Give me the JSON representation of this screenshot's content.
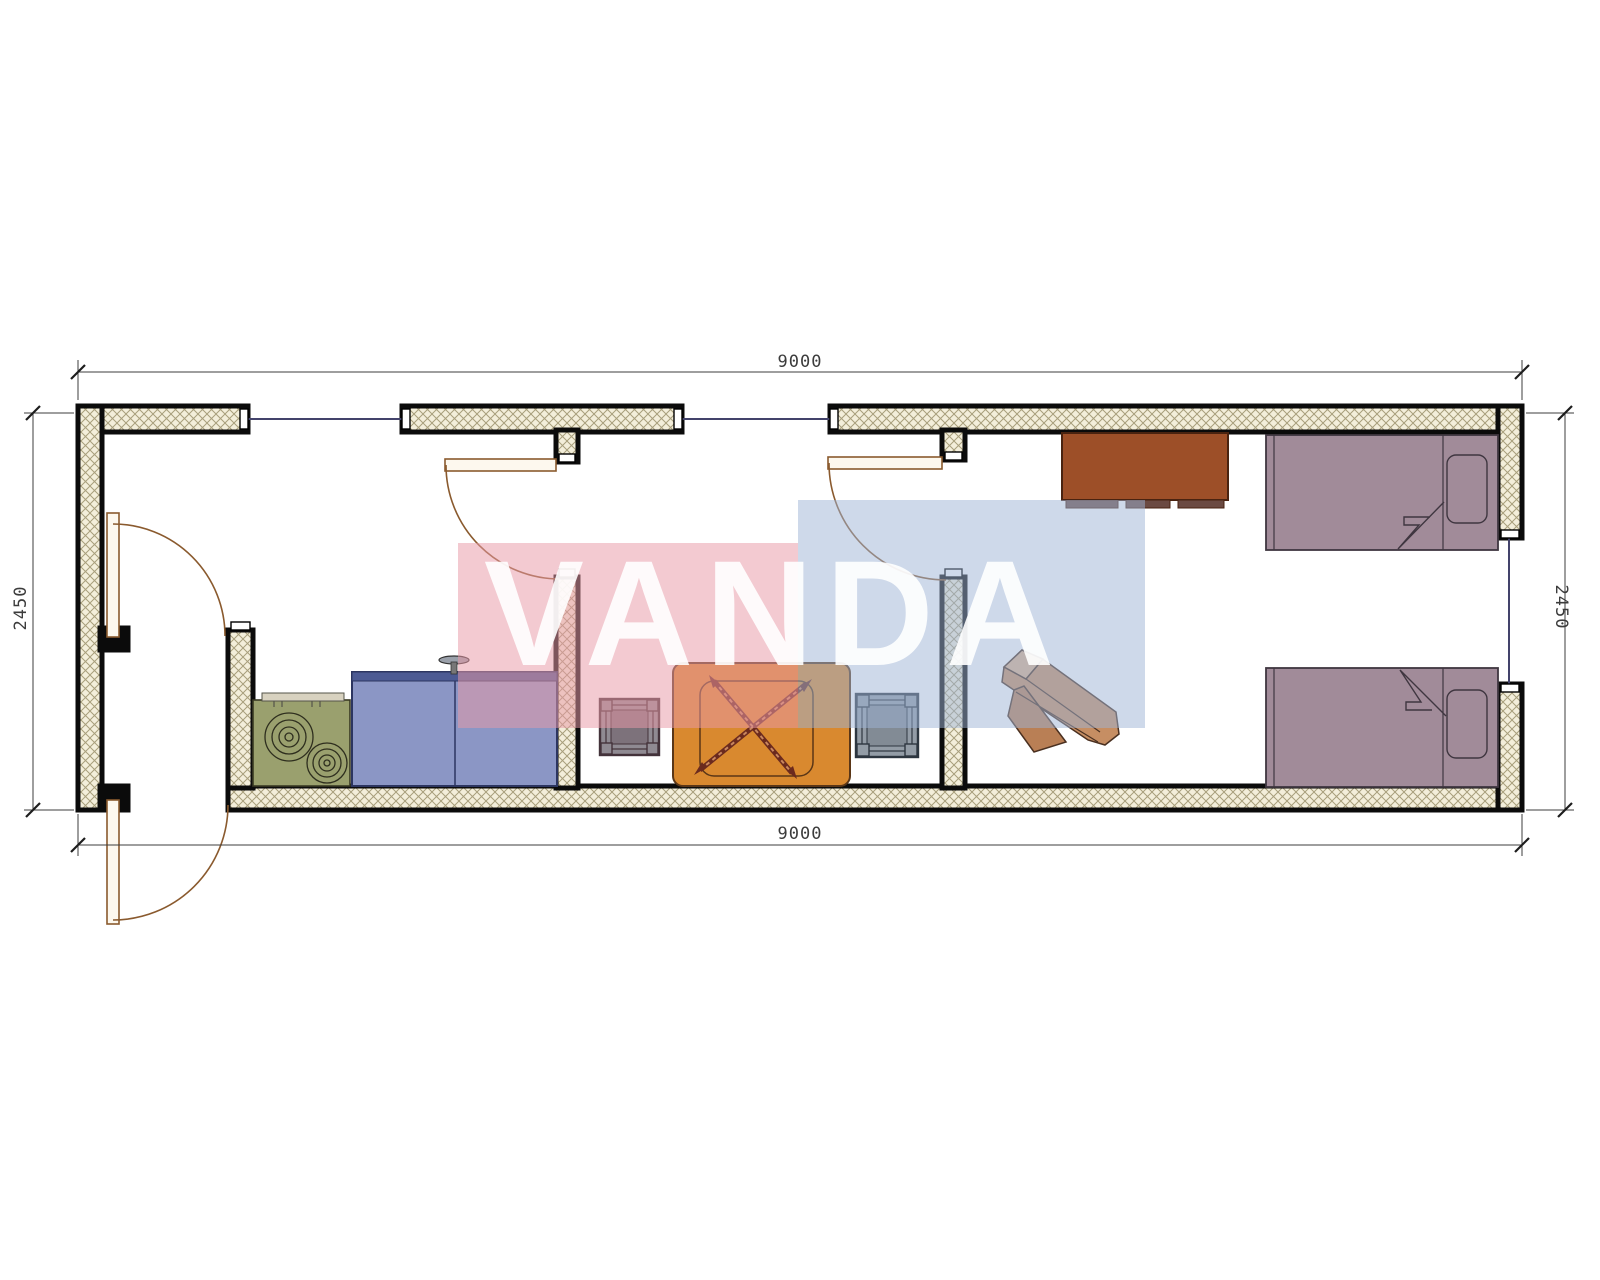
{
  "drawing": {
    "kind": "container-house-floor-plan",
    "dimensions": {
      "top": "9000",
      "bottom": "9000",
      "left": "2450",
      "right": "2450"
    },
    "watermark": {
      "text": "VANDA",
      "pink": "#e89aa7",
      "blue": "#9db4d6",
      "text_color": "#ffffff"
    },
    "colors": {
      "wall_fill": "#f3eeda",
      "wall_hatch": "#a89f7c",
      "wall_border": "#0b0b0b",
      "window_line": "#43436b",
      "door_leaf_fill": "#fdf8ee",
      "door_line": "#8a5a2e",
      "stove": "#9aa06e",
      "stove_border": "#3a3a24",
      "sink_cabinet": "#8b96c5",
      "sink_cabinet_top": "#4c5a93",
      "table": "#d9892f",
      "table_border": "#5a3617",
      "chair_cross": "#6b2a1e",
      "stool_left": "#8f8a92",
      "stool_right": "#939ca6",
      "dresser": "#9d4f28",
      "dresser_plinth": "#6b4a42",
      "wood_chair": "#c68e63",
      "wood_chair_light": "#dcb28c",
      "wood_chair_dark": "#b97f55",
      "bed": "#a18b99",
      "bed_border": "#3f3640",
      "dimension_text": "#3c3c3c"
    }
  }
}
